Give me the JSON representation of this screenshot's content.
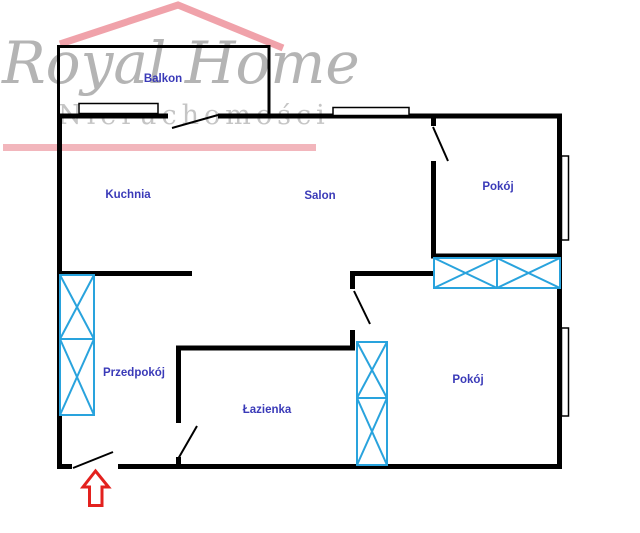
{
  "watermark": {
    "brand": "Royal Home",
    "subtitle": "Nieruchomości"
  },
  "floorplan": {
    "rooms": [
      {
        "label": "Balkon"
      },
      {
        "label": "Kuchnia"
      },
      {
        "label": "Salon"
      },
      {
        "label": "Pokój"
      },
      {
        "label": "Przedpokój"
      },
      {
        "label": "Łazienka"
      },
      {
        "label": "Pokój"
      }
    ],
    "entrance_marker": "entrance-arrow"
  },
  "colors": {
    "wall": "#000000",
    "room_label": "#3a3ab8",
    "fixture_hatch": "#29a3dd",
    "entrance_arrow": "#e3211e",
    "logo_roof_pink": "#f0a2aa",
    "logo_underline_pink": "#f2b6bc",
    "logo_text_gray": "#b4b4b4",
    "logo_subtitle_gray": "#c5c5c5"
  }
}
